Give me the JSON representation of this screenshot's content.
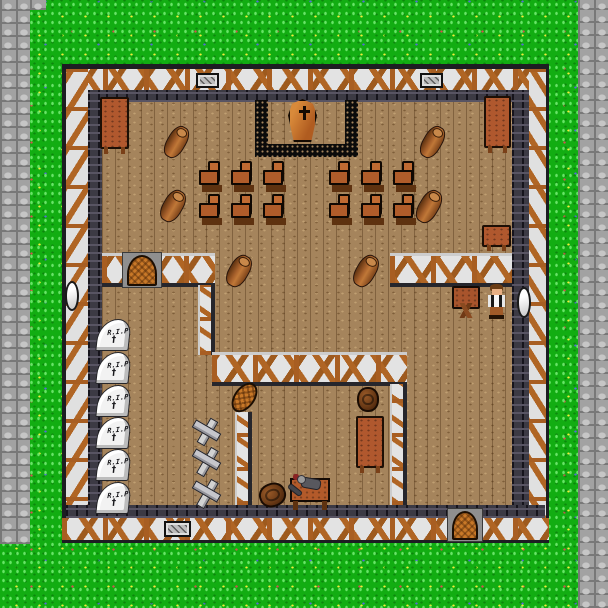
{
  "scene_type": "funeral-chapel-interior-map",
  "gravestone_epitaph": "R.I.P",
  "glyphs": {
    "grave_cross": "†"
  },
  "palette": {
    "grass": "#12ad12",
    "stone_path": "#a2a2a2",
    "floor_wood": "#a5845c",
    "wall_plaster": "#e3e3e3",
    "wall_timber": "#b06524",
    "wall_stone_dark": "#3c3a44",
    "dais_border": "#0b0b0b",
    "coffin": "#c87828",
    "table_wood": "#b0582e",
    "gravestone": "#f2f2f2",
    "npc_shirt": "#e8e8e8",
    "npc_vest": "#181818",
    "npc_pants": "#a05a28"
  },
  "counts": {
    "chairs": 12,
    "gravestones": 6,
    "grave_crosses": 3,
    "logs": 6,
    "doors": 2,
    "windows": 2,
    "wall_grates": 3,
    "barrels": 2,
    "tables": 4,
    "desks": 1,
    "coffins": 1,
    "npcs": 1,
    "corpses": 1
  },
  "objects": [
    {
      "type": "grate",
      "name": "wall-grate",
      "x": 196,
      "y": 73,
      "w": 23,
      "h": 15,
      "interactable": false
    },
    {
      "type": "grate",
      "name": "wall-grate",
      "x": 420,
      "y": 73,
      "w": 23,
      "h": 15,
      "interactable": false
    },
    {
      "type": "grate",
      "name": "wall-grate",
      "x": 164,
      "y": 521,
      "w": 27,
      "h": 16,
      "interactable": false
    },
    {
      "type": "window-oval",
      "name": "window",
      "x": 65,
      "y": 281,
      "w": 14,
      "h": 30,
      "interactable": false
    },
    {
      "type": "window-oval",
      "name": "window",
      "x": 517,
      "y": 287,
      "w": 14,
      "h": 31,
      "interactable": false
    },
    {
      "type": "table-v",
      "name": "table",
      "x": 100,
      "y": 97,
      "w": 29,
      "h": 52,
      "interactable": true
    },
    {
      "type": "table-v",
      "name": "table",
      "x": 484,
      "y": 96,
      "w": 27,
      "h": 52,
      "interactable": true
    },
    {
      "type": "table-h",
      "name": "table",
      "x": 482,
      "y": 225,
      "w": 29,
      "h": 22,
      "interactable": true
    },
    {
      "type": "table-v",
      "name": "table",
      "x": 356,
      "y": 416,
      "w": 28,
      "h": 52,
      "interactable": true
    },
    {
      "type": "desk-x",
      "name": "writing-desk",
      "x": 452,
      "y": 286,
      "w": 28,
      "h": 32,
      "interactable": true
    },
    {
      "type": "barrel",
      "name": "barrel",
      "x": 357,
      "y": 387,
      "w": 22,
      "h": 25,
      "interactable": true
    },
    {
      "type": "barrel",
      "name": "barrel",
      "x": 259,
      "y": 483,
      "w": 27,
      "h": 24,
      "rot": -20,
      "interactable": true
    },
    {
      "type": "door-arch",
      "name": "door-west-room",
      "x": 122,
      "y": 252,
      "w": 40,
      "h": 36,
      "interactable": true
    },
    {
      "type": "door-arch",
      "name": "door-south",
      "x": 447,
      "y": 508,
      "w": 36,
      "h": 34,
      "interactable": true
    },
    {
      "type": "woven-oval",
      "name": "wicker-panel",
      "x": 234,
      "y": 381,
      "w": 21,
      "h": 33,
      "rot": 36,
      "interactable": true
    },
    {
      "type": "log",
      "name": "log",
      "x": 167,
      "y": 125,
      "w": 19,
      "h": 34,
      "rot": 30,
      "interactable": true
    },
    {
      "type": "log",
      "name": "log",
      "x": 163,
      "y": 189,
      "w": 20,
      "h": 34,
      "rot": 30,
      "interactable": true
    },
    {
      "type": "log",
      "name": "log",
      "x": 423,
      "y": 125,
      "w": 19,
      "h": 34,
      "rot": 30,
      "interactable": true
    },
    {
      "type": "log",
      "name": "log",
      "x": 419,
      "y": 189,
      "w": 20,
      "h": 35,
      "rot": 30,
      "interactable": true
    },
    {
      "type": "log",
      "name": "log",
      "x": 229,
      "y": 254,
      "w": 20,
      "h": 34,
      "rot": 30,
      "interactable": true
    },
    {
      "type": "log",
      "name": "log",
      "x": 356,
      "y": 254,
      "w": 20,
      "h": 34,
      "rot": 30,
      "interactable": true
    },
    {
      "type": "chair",
      "name": "chair",
      "x": 199,
      "y": 161,
      "w": 23,
      "h": 26,
      "interactable": true
    },
    {
      "type": "chair",
      "name": "chair",
      "x": 231,
      "y": 161,
      "w": 23,
      "h": 26,
      "interactable": true
    },
    {
      "type": "chair",
      "name": "chair",
      "x": 263,
      "y": 161,
      "w": 23,
      "h": 26,
      "interactable": true
    },
    {
      "type": "chair",
      "name": "chair",
      "x": 199,
      "y": 194,
      "w": 23,
      "h": 26,
      "interactable": true
    },
    {
      "type": "chair",
      "name": "chair",
      "x": 231,
      "y": 194,
      "w": 23,
      "h": 26,
      "interactable": true
    },
    {
      "type": "chair",
      "name": "chair",
      "x": 263,
      "y": 194,
      "w": 23,
      "h": 26,
      "interactable": true
    },
    {
      "type": "chair",
      "name": "chair",
      "x": 329,
      "y": 161,
      "w": 23,
      "h": 26,
      "interactable": true
    },
    {
      "type": "chair",
      "name": "chair",
      "x": 361,
      "y": 161,
      "w": 23,
      "h": 26,
      "interactable": true
    },
    {
      "type": "chair",
      "name": "chair",
      "x": 393,
      "y": 161,
      "w": 23,
      "h": 26,
      "interactable": true
    },
    {
      "type": "chair",
      "name": "chair",
      "x": 329,
      "y": 194,
      "w": 23,
      "h": 26,
      "interactable": true
    },
    {
      "type": "chair",
      "name": "chair",
      "x": 361,
      "y": 194,
      "w": 23,
      "h": 26,
      "interactable": true
    },
    {
      "type": "chair",
      "name": "chair",
      "x": 393,
      "y": 194,
      "w": 23,
      "h": 26,
      "interactable": true
    },
    {
      "type": "gravestone",
      "name": "gravestone",
      "x": 97,
      "y": 319,
      "w": 33,
      "h": 32,
      "interactable": true
    },
    {
      "type": "gravestone",
      "name": "gravestone",
      "x": 97,
      "y": 352,
      "w": 33,
      "h": 32,
      "interactable": true
    },
    {
      "type": "gravestone",
      "name": "gravestone",
      "x": 97,
      "y": 385,
      "w": 33,
      "h": 32,
      "interactable": true
    },
    {
      "type": "gravestone",
      "name": "gravestone",
      "x": 97,
      "y": 417,
      "w": 33,
      "h": 32,
      "interactable": true
    },
    {
      "type": "gravestone",
      "name": "gravestone",
      "x": 97,
      "y": 449,
      "w": 33,
      "h": 32,
      "interactable": true
    },
    {
      "type": "gravestone",
      "name": "gravestone",
      "x": 97,
      "y": 482,
      "w": 33,
      "h": 32,
      "interactable": true
    },
    {
      "type": "grave-cross",
      "name": "grave-marker-cross",
      "x": 191,
      "y": 419,
      "w": 31,
      "h": 28,
      "interactable": true
    },
    {
      "type": "grave-cross",
      "name": "grave-marker-cross",
      "x": 191,
      "y": 448,
      "w": 31,
      "h": 30,
      "interactable": true
    },
    {
      "type": "grave-cross",
      "name": "grave-marker-cross",
      "x": 191,
      "y": 480,
      "w": 31,
      "h": 30,
      "interactable": true
    }
  ]
}
